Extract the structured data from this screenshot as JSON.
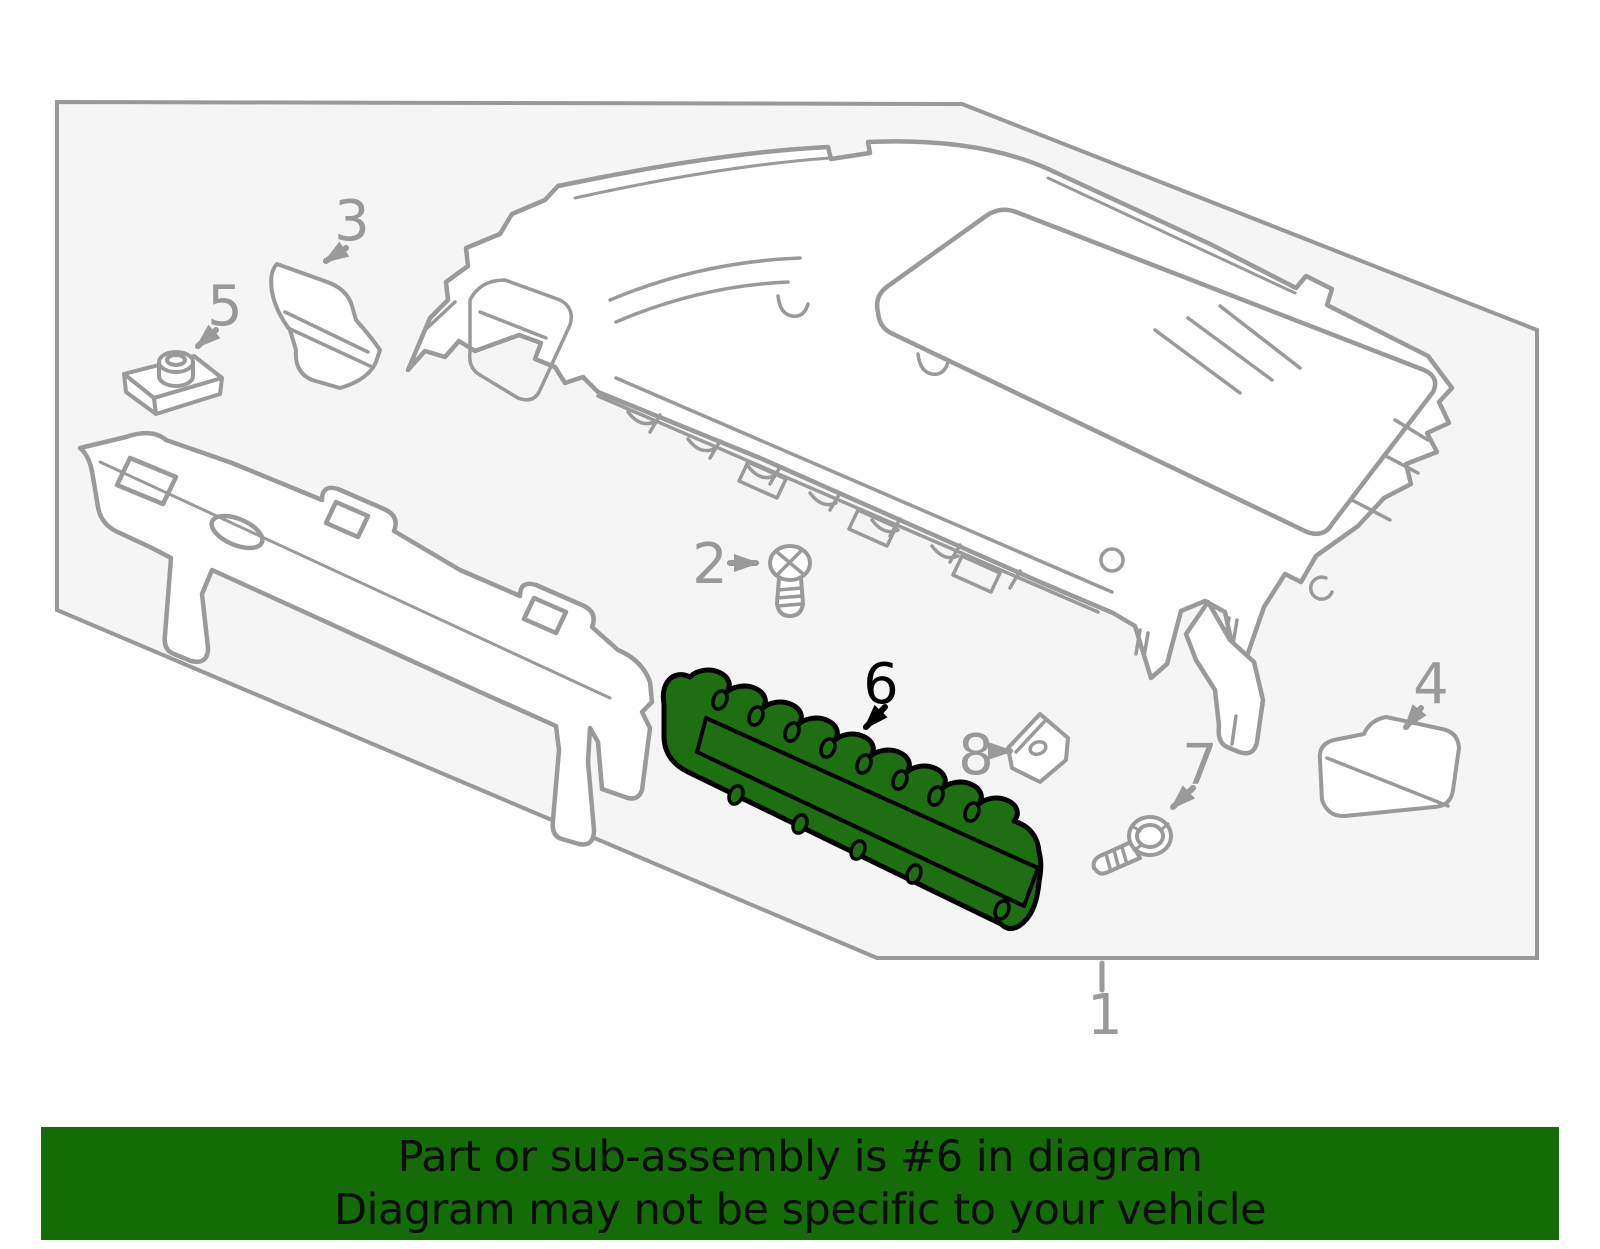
{
  "banner": {
    "line1": "Part or sub-assembly is #6 in diagram",
    "line2": "Diagram may not be specific to your vehicle",
    "bg_color": "#146C06",
    "text_color": "#0d0d0d"
  },
  "diagram": {
    "highlighted_part": "6",
    "highlight_color": "#1E6E12",
    "highlight_outline_color": "#000000",
    "line_color": "#9A9A9A",
    "label_color": "#999999",
    "border_color": "#999999",
    "background_color": "#F5F5F6",
    "labels": [
      {
        "text": "1",
        "color": "#999999"
      },
      {
        "text": "2",
        "color": "#999999"
      },
      {
        "text": "3",
        "color": "#999999"
      },
      {
        "text": "4",
        "color": "#999999"
      },
      {
        "text": "5",
        "color": "#999999"
      },
      {
        "text": "6",
        "color": "#000000"
      },
      {
        "text": "7",
        "color": "#999999"
      },
      {
        "text": "8",
        "color": "#999999"
      }
    ]
  }
}
